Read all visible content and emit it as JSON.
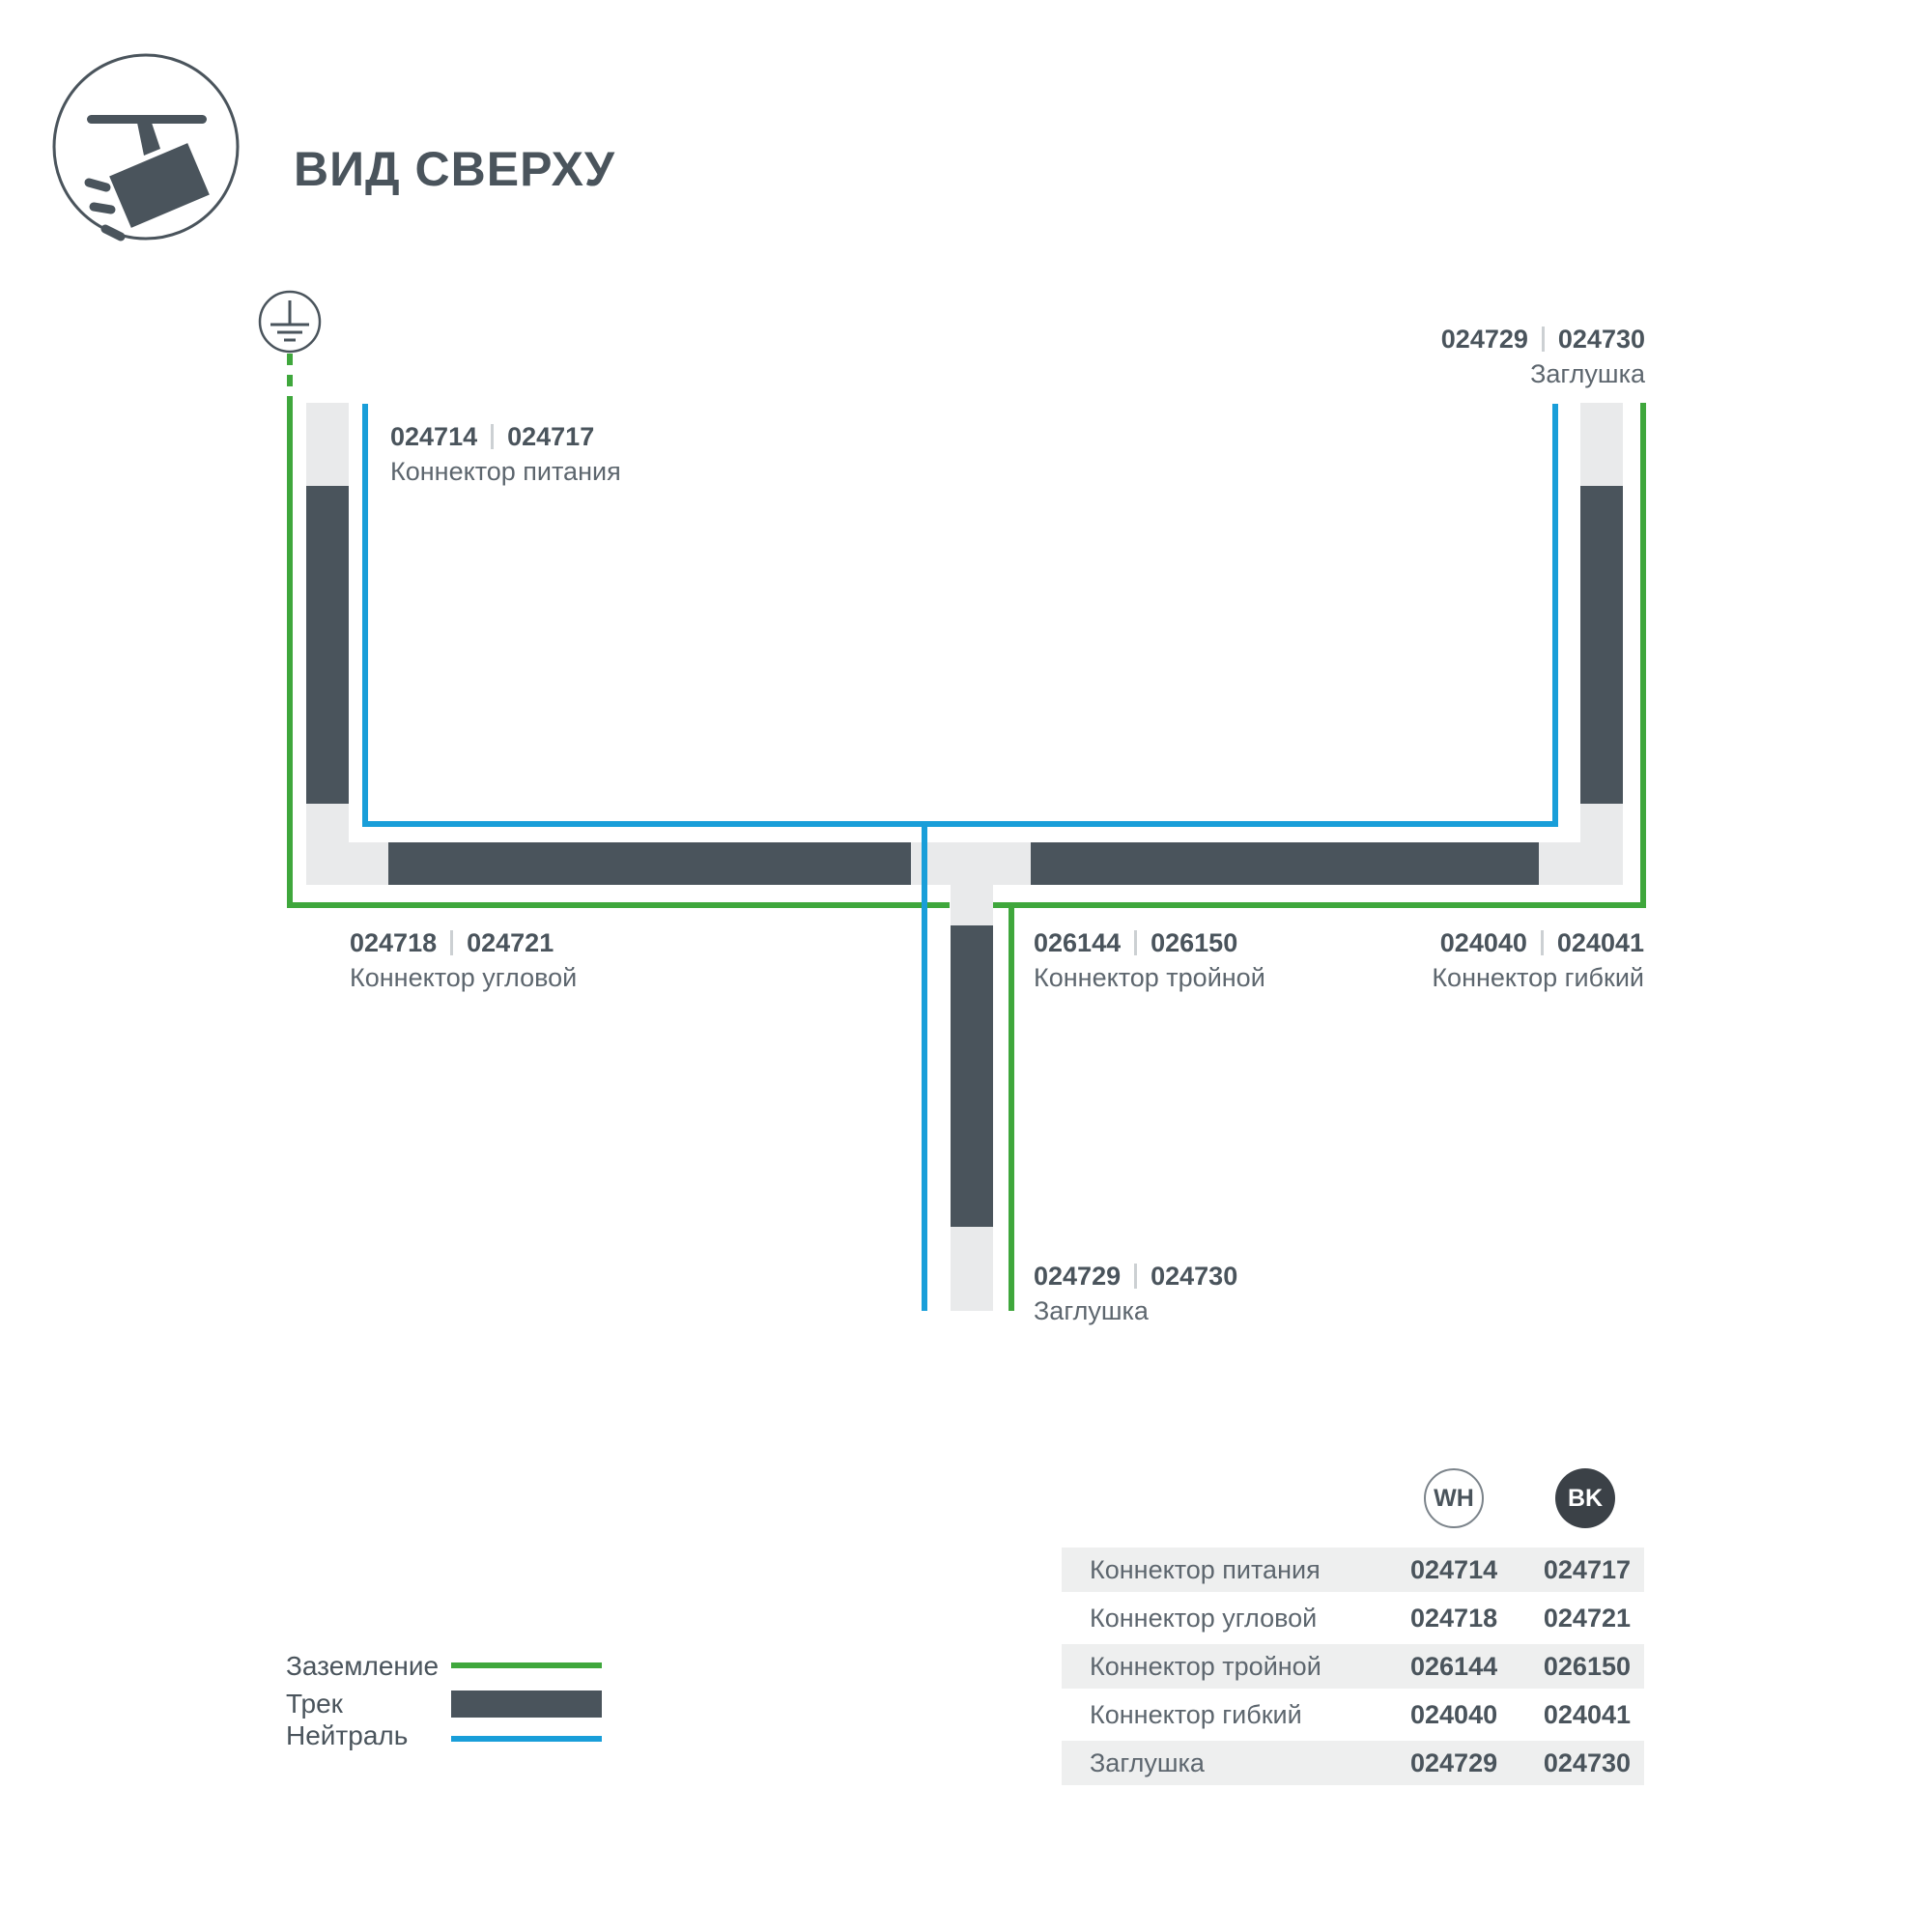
{
  "title": "ВИД СВЕРХУ",
  "colors": {
    "track_dark": "#4A545C",
    "track_light": "#E9EAEB",
    "ground_green": "#3FA73C",
    "neutral_blue": "#199ED9",
    "text_primary": "#4A545C",
    "text_secondary": "#5D666E",
    "row_shade": "#EEEFEF",
    "bk_badge": "#3B4147",
    "separator": "#CCD0D3"
  },
  "diagram": {
    "labels": {
      "power": {
        "wh": "024714",
        "bk": "024717",
        "name": "Коннектор питания"
      },
      "endcap_top": {
        "wh": "024729",
        "bk": "024730",
        "name": "Заглушка"
      },
      "corner": {
        "wh": "024718",
        "bk": "024721",
        "name": "Коннектор угловой"
      },
      "triple": {
        "wh": "026144",
        "bk": "026150",
        "name": "Коннектор тройной"
      },
      "flexible": {
        "wh": "024040",
        "bk": "024041",
        "name": "Коннектор гибкий"
      },
      "endcap_bottom": {
        "wh": "024729",
        "bk": "024730",
        "name": "Заглушка"
      }
    }
  },
  "legend": {
    "items": [
      {
        "label": "Заземление",
        "swatch": "ground-line"
      },
      {
        "label": "Трек",
        "swatch": "track-bar"
      },
      {
        "label": "Нейтраль",
        "swatch": "neutral-line"
      }
    ]
  },
  "table": {
    "col_wh": "WH",
    "col_bk": "BK",
    "rows": [
      {
        "name": "Коннектор питания",
        "wh": "024714",
        "bk": "024717"
      },
      {
        "name": "Коннектор угловой",
        "wh": "024718",
        "bk": "024721"
      },
      {
        "name": "Коннектор тройной",
        "wh": "026144",
        "bk": "026150"
      },
      {
        "name": "Коннектор гибкий",
        "wh": "024040",
        "bk": "024041"
      },
      {
        "name": "Заглушка",
        "wh": "024729",
        "bk": "024730"
      }
    ]
  }
}
